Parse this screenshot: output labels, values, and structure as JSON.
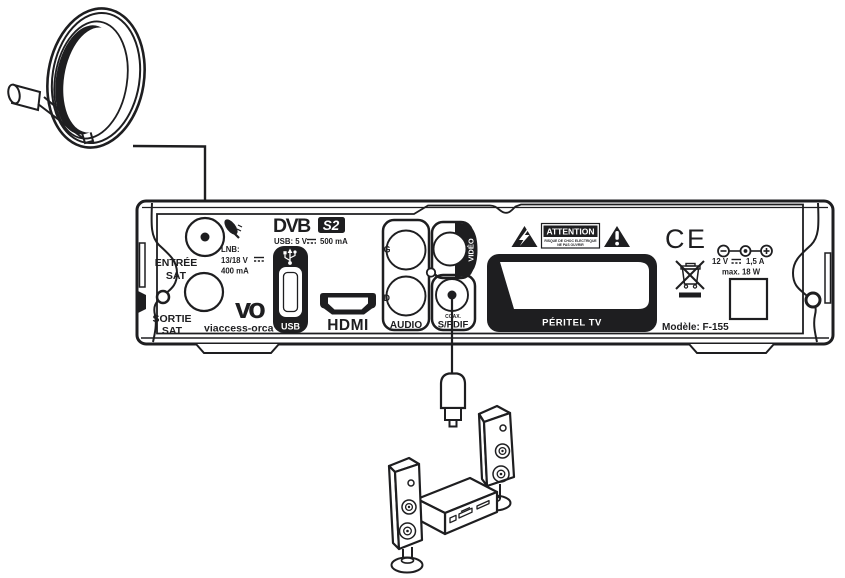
{
  "diagram_type": "satellite receiver rear-panel connection diagram",
  "colors": {
    "ink": "#1e1e20",
    "paper": "#ffffff"
  },
  "panel": {
    "entree_line1": "ENTRÉE",
    "entree_line2": "SAT",
    "sortie_line1": "SORTIE",
    "sortie_line2": "SAT",
    "lnb_title": "LNB:",
    "lnb_voltage": "13/18 V",
    "lnb_current": "400 mA",
    "dvb": "DVB",
    "dvb_s2": "S2",
    "usb_power": "USB: 5 V",
    "usb_current": "500 mA",
    "vo_logo": "vo",
    "viaccess": "viaccess-orca",
    "usb": "USB",
    "hdmi": "HDMI",
    "audio_g": "G",
    "audio_d": "D",
    "audio": "AUDIO",
    "video": "VIDÉO",
    "coax": "COAX.",
    "spdif": "S/PDIF",
    "attention": "ATTENTION",
    "attention_sub1": "RISQUE DE CHOC ELECTRIQUE",
    "attention_sub2": "NE PAS OUVRIR",
    "peritel": "PÉRITEL TV",
    "ce": "CE",
    "power_voltage": "12 V",
    "power_current": "1,5 A",
    "power_max": "max. 18 W",
    "model": "Modèle: F-155"
  },
  "icons": {
    "satellite-dish": "parabolic antenna with LNB arm",
    "satellite-dish-small": "mini dish glyph beside SAT input",
    "dc-symbol": "solid line over dashed line (direct current)",
    "usb-trident": "USB branching symbol",
    "lightning-triangle": "black triangle with lightning bolt",
    "exclamation-triangle": "black triangle with exclamation mark",
    "weee-bin": "crossed-out wheeled bin",
    "polarity": "minus / center pin / plus DC polarity",
    "rca-plug": "coaxial audio plug on cable",
    "speakers": "two tower speakers with amplifier"
  }
}
